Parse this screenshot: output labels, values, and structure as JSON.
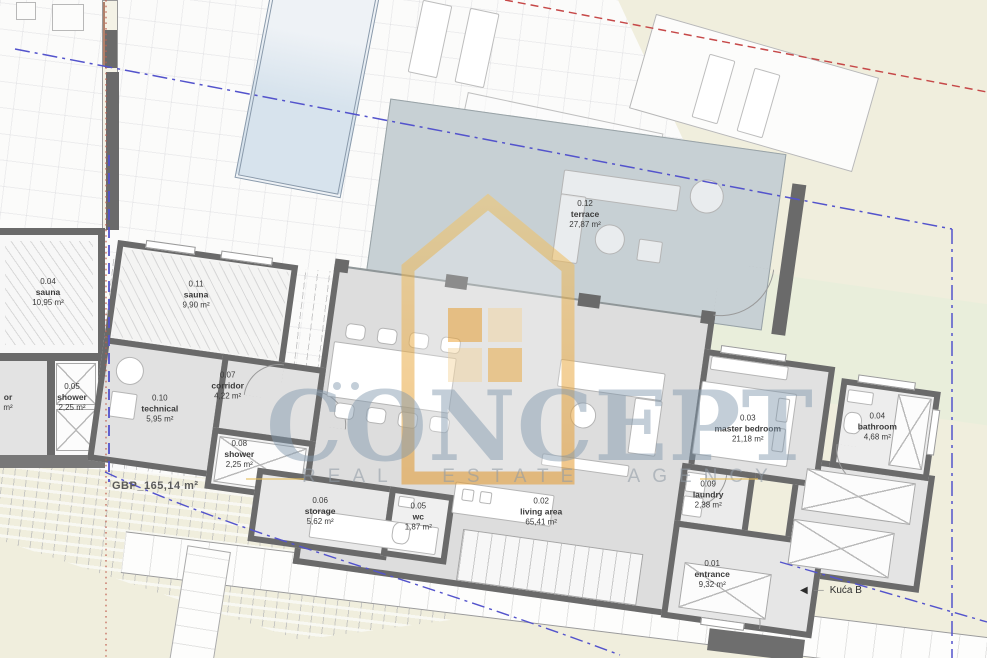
{
  "watermark": {
    "brand": "CONCEPT",
    "tagline": "REAL ESTATE AGENCY"
  },
  "plan": {
    "gbp_label": "GBP_165,14 m²",
    "house_ref": {
      "arrow": "◀",
      "label": "Kuća B"
    },
    "rooms": [
      {
        "id": "0.01",
        "name": "entrance",
        "area": "9,32 m²"
      },
      {
        "id": "0.02",
        "name": "living area",
        "area": "65,41 m²"
      },
      {
        "id": "0.03",
        "name": "master bedroom",
        "area": "21,18 m²"
      },
      {
        "id": "0.04",
        "name": "bathroom",
        "area": "4,68 m²"
      },
      {
        "id": "0.05",
        "name": "wc",
        "area": "1,87 m²"
      },
      {
        "id": "0.06",
        "name": "storage",
        "area": "5,62 m²"
      },
      {
        "id": "0.07",
        "name": "corridor",
        "area": "4,22 m²"
      },
      {
        "id": "0.08",
        "name": "shower",
        "area": "2,25 m²"
      },
      {
        "id": "0.09",
        "name": "laundry",
        "area": "2,38 m²"
      },
      {
        "id": "0.10",
        "name": "technical",
        "area": "5,95 m²"
      },
      {
        "id": "0.11",
        "name": "sauna",
        "area": "9,90 m²"
      },
      {
        "id": "0.12",
        "name": "terrace",
        "area": "27,87 m²"
      }
    ],
    "adjacent_building": {
      "rooms": [
        {
          "id": "0.04",
          "name": "sauna",
          "area": "10,95 m²"
        },
        {
          "id": "0.05",
          "name": "shower",
          "area": "2,25 m²"
        },
        {
          "id": "",
          "name": "or",
          "area": "m²"
        }
      ]
    }
  },
  "colors": {
    "ground_cream": "#f0eedd",
    "deck_white": "#fbfbfa",
    "room_floor": "#dddddd",
    "wall": "#6a6a6a",
    "terrace_floor": "#c7d0d4",
    "pool_blue": "#dce7ef",
    "garden_green": "#e9eedb",
    "boundary_blue": "#5353cc",
    "boundary_red": "#c64848",
    "watermark_blue": "#8298ae",
    "logo_orange": "#eda63a"
  }
}
